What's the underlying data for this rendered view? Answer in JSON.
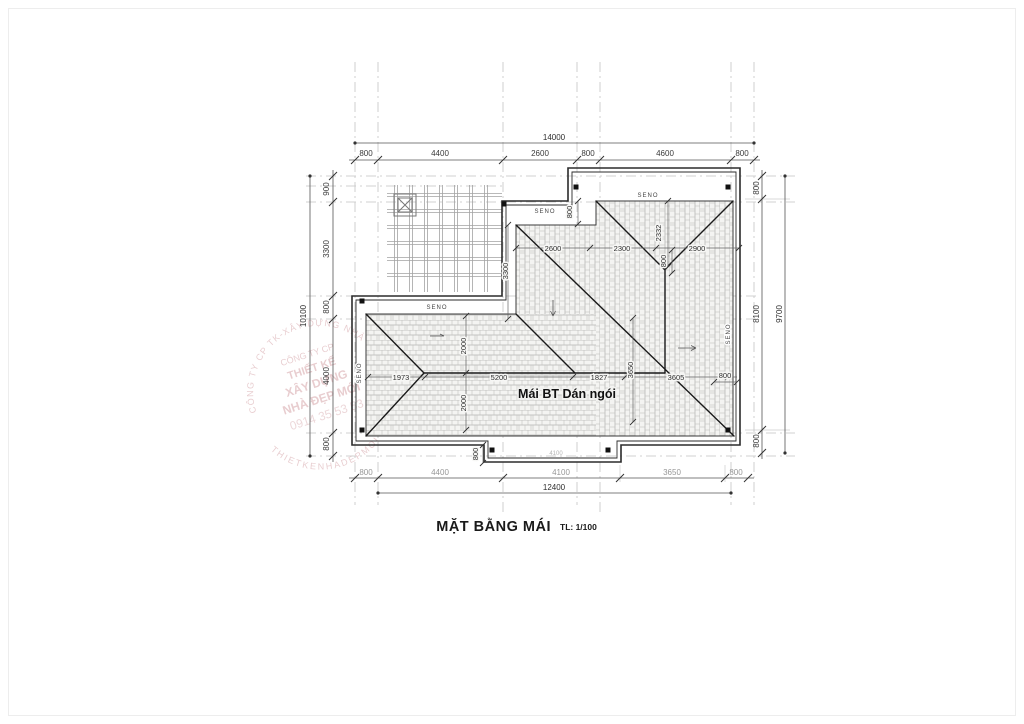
{
  "title": {
    "main": "MẶT BẰNG MÁI",
    "scale": "TL: 1/100"
  },
  "roof": {
    "material_label": "Mái BT Dán ngói",
    "gutter_label": "SENO"
  },
  "dimensions": {
    "top": {
      "total": "14000",
      "segments": [
        "800",
        "4400",
        "2600",
        "800",
        "4600",
        "800"
      ]
    },
    "bottom": {
      "total": "12400",
      "segments": [
        "800",
        "4400",
        "4100",
        "3650",
        "800"
      ]
    },
    "left": {
      "total": "10100",
      "segments": [
        "900",
        "3300",
        "800",
        "4000",
        "800"
      ]
    },
    "right": {
      "total": "9700",
      "segments": [
        "800",
        "8100",
        "800"
      ]
    },
    "interior": {
      "d1973": "1973",
      "d5200": "5200",
      "d1827": "1827",
      "d3605": "3605",
      "d2000": "2000",
      "d3300": "3300",
      "d3650": "3650",
      "d2600": "2600",
      "d2300": "2300",
      "d2900": "2900",
      "d2332": "2332",
      "d800": "800",
      "d4100": "4100"
    }
  },
  "watermark": {
    "ring_top": "CÔNG TY CP TK-XÂY DỰNG NHÀ ĐẸP MỚI",
    "ring_bottom": "THIETKENHADEPMOI",
    "lines": [
      "CÔNG TY CP",
      "THIẾT KẾ",
      "XÂY DỰNG",
      "NHÀ ĐẸP MỚI",
      "0914 35 53 53"
    ]
  },
  "colors": {
    "outline": "#2b2b2b",
    "grid": "#c4c4c4",
    "tile_joint": "#b5b5b2",
    "watermark": "#c9898f"
  }
}
